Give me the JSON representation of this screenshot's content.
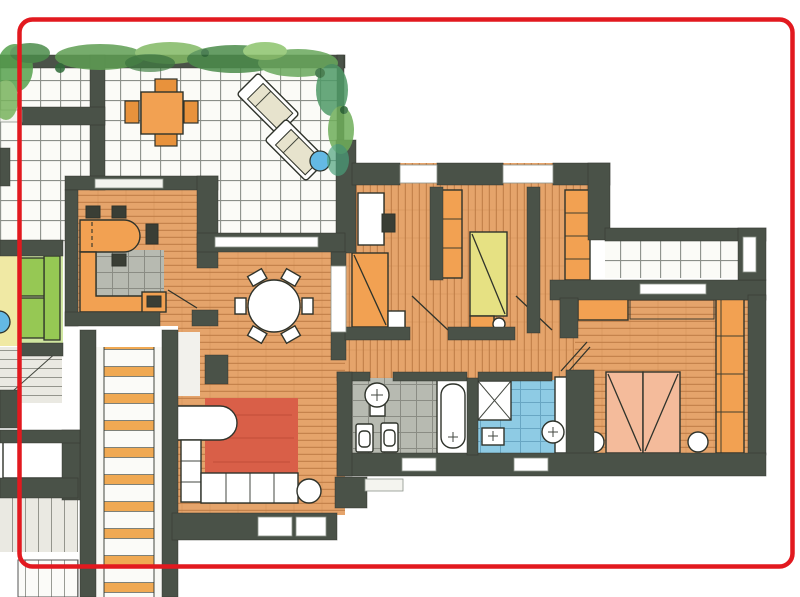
{
  "annotation": {
    "border_color": "#e2191f"
  },
  "palette": {
    "wall": "#4a5248",
    "outline": "#2f332b",
    "wood": "#e5a46b",
    "wood_line": "#bd7b45",
    "tile_bg": "#fbfbf7",
    "tile_line": "#6f746e",
    "gray_tile": "#b7bab1",
    "gray_tile_line": "#7e8179",
    "blue_tile": "#8ecbe4",
    "blue_tile_line": "#5f9cba",
    "orange": "#f2a152",
    "orange_deep": "#e8923c",
    "beige": "#e7e3cd",
    "yellow": "#e6e183",
    "peach": "#f4bb9b",
    "red_rug": "#d95f48",
    "green_floor": "#cfe6a0",
    "green_sofa": "#96c854",
    "yellow_floor": "#f0e9a4",
    "blue_accent": "#64b9e4",
    "step_orange": "#f0a953"
  },
  "rooms": [
    {
      "name": "roof terrace"
    },
    {
      "name": "kitchen"
    },
    {
      "name": "living / dining room"
    },
    {
      "name": "lounge"
    },
    {
      "name": "bedroom 1"
    },
    {
      "name": "bedroom 2"
    },
    {
      "name": "master bedroom"
    },
    {
      "name": "bathroom"
    },
    {
      "name": "shower bathroom"
    },
    {
      "name": "balcony"
    },
    {
      "name": "staircase"
    },
    {
      "name": "hallway"
    },
    {
      "name": "dressing"
    }
  ]
}
